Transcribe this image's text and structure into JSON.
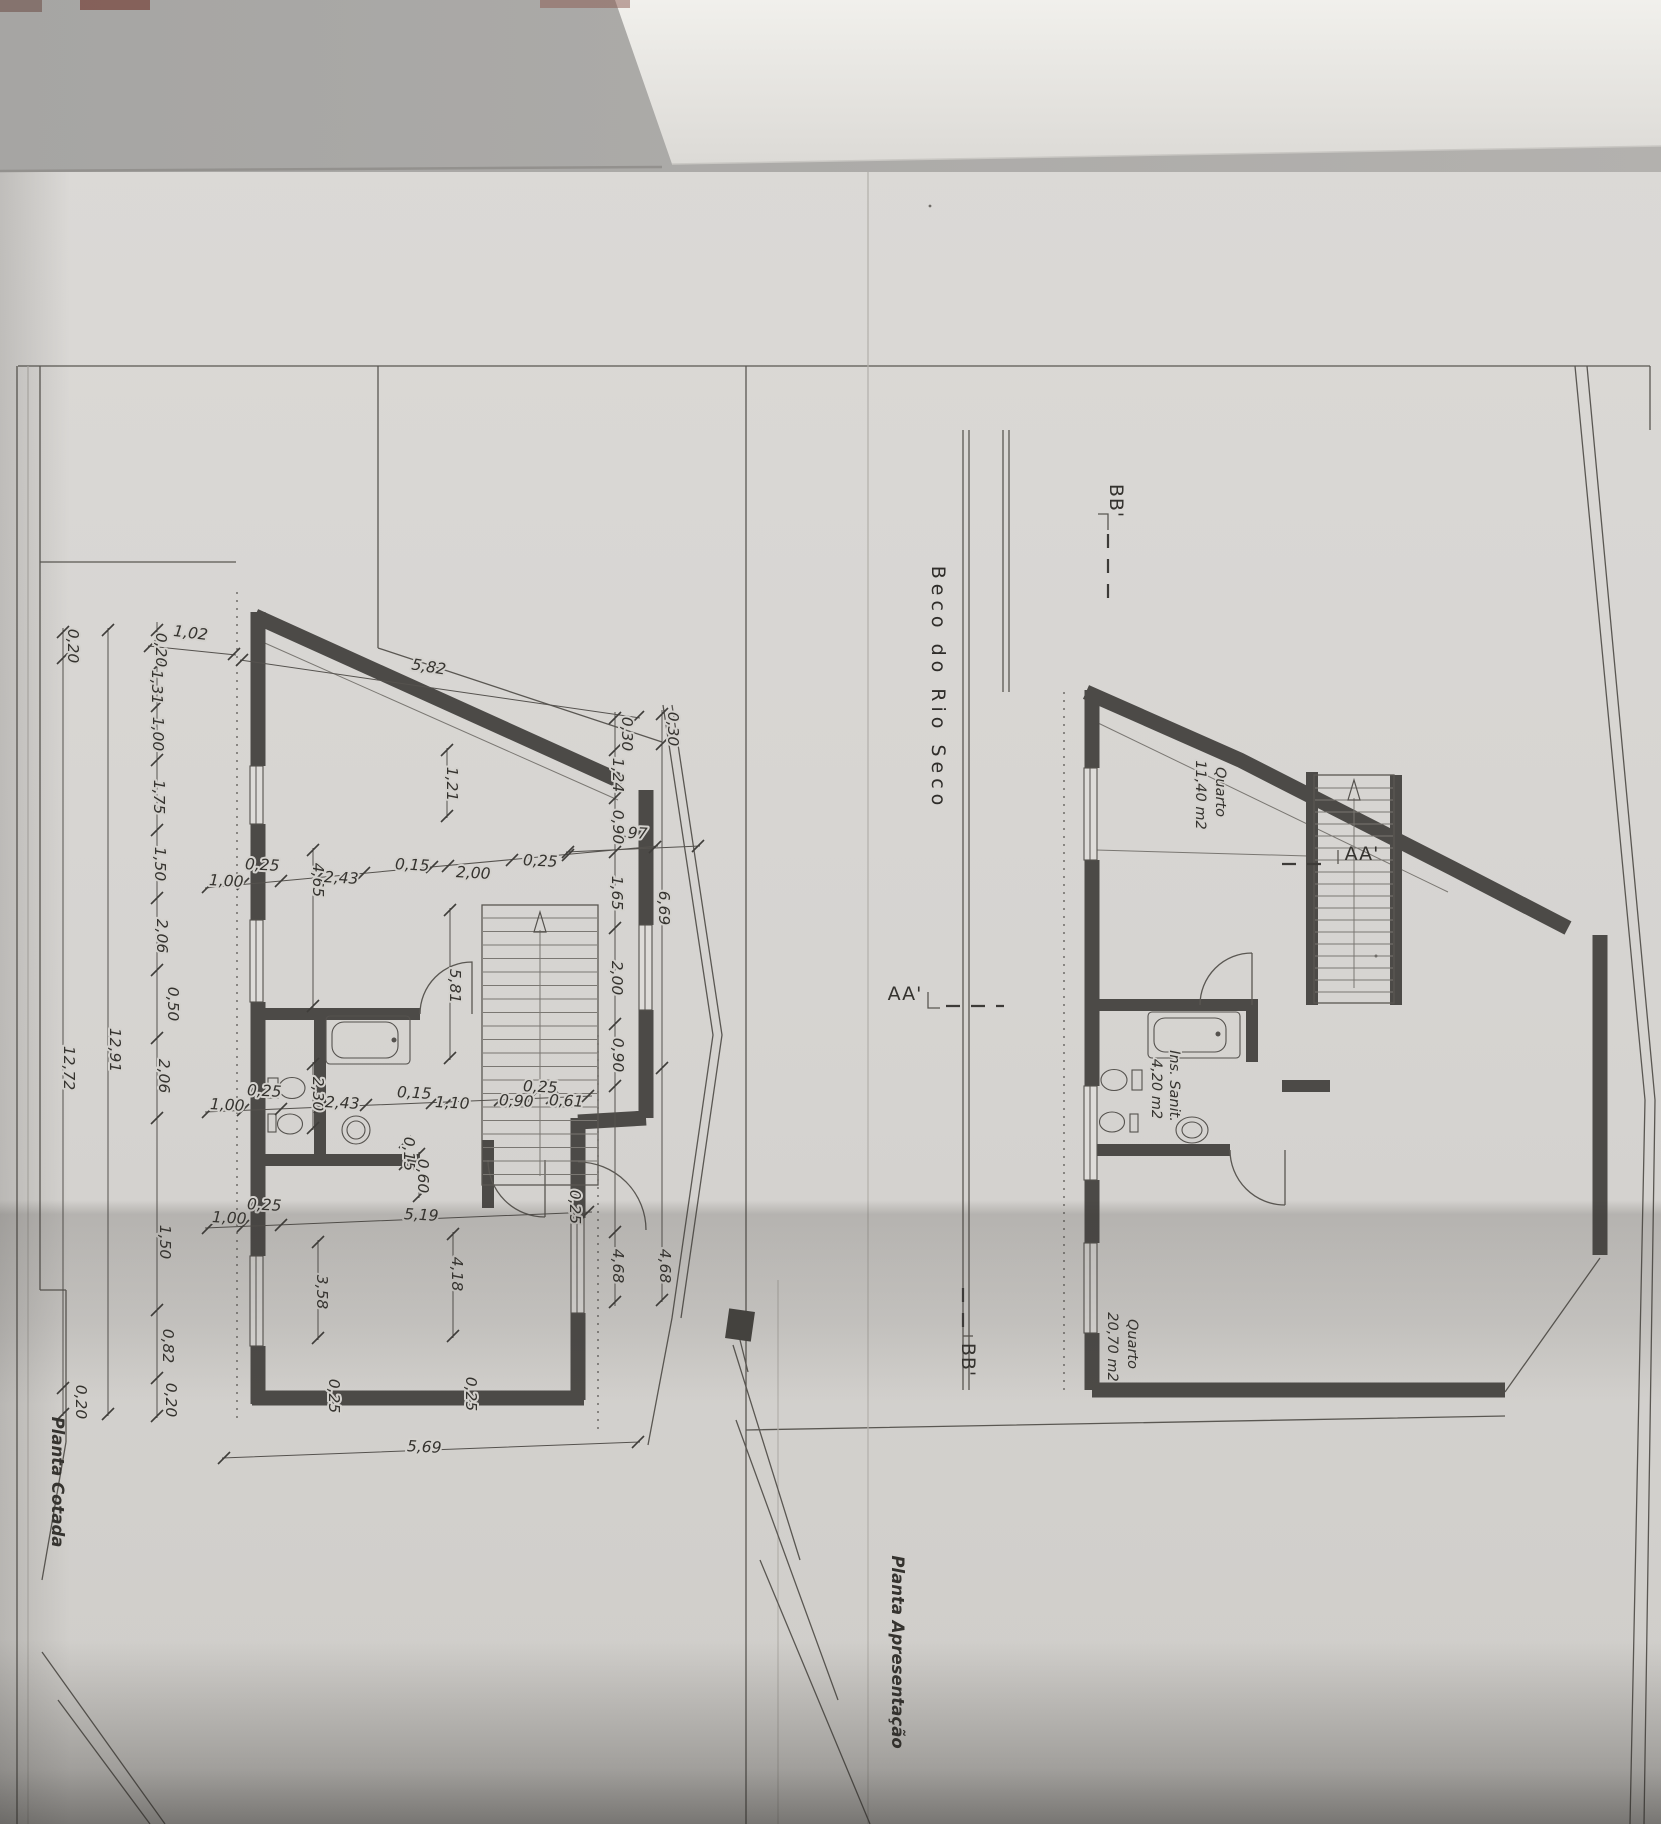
{
  "street_label": "Beco do Rio Seco",
  "markers": {
    "aa": "AA'",
    "bb": "BB'"
  },
  "plans": {
    "cotada": {
      "title": "Planta Cotada",
      "dim_labels": [
        {
          "t": "1,02",
          "x": 190,
          "y": 638,
          "r": 7
        },
        {
          "t": "5,82",
          "x": 428,
          "y": 672,
          "r": 9
        },
        {
          "t": "0,20",
          "x": 68,
          "y": 646,
          "r": 90
        },
        {
          "t": "12,72",
          "x": 64,
          "y": 1068,
          "r": 90
        },
        {
          "t": "0,20",
          "x": 76,
          "y": 1402,
          "r": 90
        },
        {
          "t": "12,91",
          "x": 110,
          "y": 1050,
          "r": 90
        },
        {
          "t": "0,20",
          "x": 156,
          "y": 650,
          "r": 90
        },
        {
          "t": "1,31",
          "x": 152,
          "y": 687,
          "r": 90
        },
        {
          "t": "1,00",
          "x": 153,
          "y": 734,
          "r": 90
        },
        {
          "t": "1,75",
          "x": 154,
          "y": 797,
          "r": 90
        },
        {
          "t": "1,50",
          "x": 155,
          "y": 864,
          "r": 90
        },
        {
          "t": "2,06",
          "x": 157,
          "y": 936,
          "r": 90
        },
        {
          "t": "0,50",
          "x": 168,
          "y": 1004,
          "r": 90
        },
        {
          "t": "2,06",
          "x": 159,
          "y": 1076,
          "r": 90
        },
        {
          "t": "1,50",
          "x": 160,
          "y": 1242,
          "r": 90
        },
        {
          "t": "0,82",
          "x": 163,
          "y": 1346,
          "r": 90
        },
        {
          "t": "0,20",
          "x": 166,
          "y": 1400,
          "r": 90
        },
        {
          "t": "1,00",
          "x": 226,
          "y": 886,
          "r": 3
        },
        {
          "t": "0,25",
          "x": 262,
          "y": 870,
          "r": 3
        },
        {
          "t": "4,65",
          "x": 313,
          "y": 880,
          "r": 90
        },
        {
          "t": "2,43",
          "x": 341,
          "y": 883,
          "r": 3
        },
        {
          "t": "0,15",
          "x": 412,
          "y": 870,
          "r": 3
        },
        {
          "t": "2,00",
          "x": 473,
          "y": 878,
          "r": 3
        },
        {
          "t": "0,25",
          "x": 540,
          "y": 866,
          "r": 3
        },
        {
          "t": "2,97",
          "x": 630,
          "y": 838,
          "r": 3
        },
        {
          "t": "1,21",
          "x": 447,
          "y": 784,
          "r": 90
        },
        {
          "t": "0,30",
          "x": 622,
          "y": 734,
          "r": 90
        },
        {
          "t": "0,30",
          "x": 668,
          "y": 729,
          "r": 90
        },
        {
          "t": "1,24",
          "x": 613,
          "y": 775,
          "r": 90
        },
        {
          "t": "0,90",
          "x": 613,
          "y": 827,
          "r": 90
        },
        {
          "t": "1,65",
          "x": 612,
          "y": 893,
          "r": 90
        },
        {
          "t": "6,69",
          "x": 659,
          "y": 908,
          "r": 90
        },
        {
          "t": "2,00",
          "x": 612,
          "y": 978,
          "r": 90
        },
        {
          "t": "0,90",
          "x": 613,
          "y": 1055,
          "r": 90
        },
        {
          "t": "4,68",
          "x": 613,
          "y": 1266,
          "r": 90
        },
        {
          "t": "4,68",
          "x": 660,
          "y": 1266,
          "r": 90
        },
        {
          "t": "1,00",
          "x": 227,
          "y": 1110,
          "r": 3
        },
        {
          "t": "0,25",
          "x": 264,
          "y": 1096,
          "r": 3
        },
        {
          "t": "2,30",
          "x": 313,
          "y": 1094,
          "r": 90
        },
        {
          "t": "2,43",
          "x": 342,
          "y": 1108,
          "r": 3
        },
        {
          "t": "0,15",
          "x": 414,
          "y": 1098,
          "r": 3
        },
        {
          "t": "1,10",
          "x": 452,
          "y": 1108,
          "r": 3
        },
        {
          "t": "0,90",
          "x": 516,
          "y": 1106,
          "r": 3
        },
        {
          "t": "0,25",
          "x": 540,
          "y": 1092,
          "r": 3
        },
        {
          "t": "0,61",
          "x": 566,
          "y": 1106,
          "r": 3
        },
        {
          "t": "5,81",
          "x": 450,
          "y": 986,
          "r": 90
        },
        {
          "t": "0,15",
          "x": 404,
          "y": 1154,
          "r": 90
        },
        {
          "t": "0,60",
          "x": 418,
          "y": 1176,
          "r": 90
        },
        {
          "t": "0,25",
          "x": 264,
          "y": 1210,
          "r": 3
        },
        {
          "t": "1,00",
          "x": 229,
          "y": 1223,
          "r": 3
        },
        {
          "t": "5,19",
          "x": 421,
          "y": 1220,
          "r": 3
        },
        {
          "t": "3,58",
          "x": 317,
          "y": 1292,
          "r": 90
        },
        {
          "t": "4,18",
          "x": 452,
          "y": 1274,
          "r": 90
        },
        {
          "t": "0,25",
          "x": 570,
          "y": 1207,
          "r": 90
        },
        {
          "t": "0,25",
          "x": 329,
          "y": 1396,
          "r": 90
        },
        {
          "t": "0,25",
          "x": 466,
          "y": 1394,
          "r": 90
        },
        {
          "t": "5,69",
          "x": 424,
          "y": 1452,
          "r": 3
        }
      ]
    },
    "apresentacao": {
      "title": "Planta Apresentação",
      "room_labels": [
        {
          "t": "Quarto",
          "x": 1216,
          "y": 792,
          "r": 90
        },
        {
          "t": "11,40 m2",
          "x": 1196,
          "y": 795,
          "r": 90
        },
        {
          "t": "Ins. Sanit.",
          "x": 1170,
          "y": 1086,
          "r": 90
        },
        {
          "t": "4,20 m2",
          "x": 1152,
          "y": 1089,
          "r": 90
        },
        {
          "t": "Quarto",
          "x": 1128,
          "y": 1344,
          "r": 90
        },
        {
          "t": "20,70 m2",
          "x": 1108,
          "y": 1347,
          "r": 90
        }
      ]
    }
  },
  "colors": {
    "paper": "#d6d4d1",
    "paper_low": "#cfcdc9",
    "ink": "#3a3835",
    "wall": "#4c4a47",
    "shadow_band": "#b7b5b2",
    "top_strip": "#a8a7a5",
    "top_strip_light": "#f1f0ec",
    "bottom_shadow": "#8e8d8b"
  }
}
